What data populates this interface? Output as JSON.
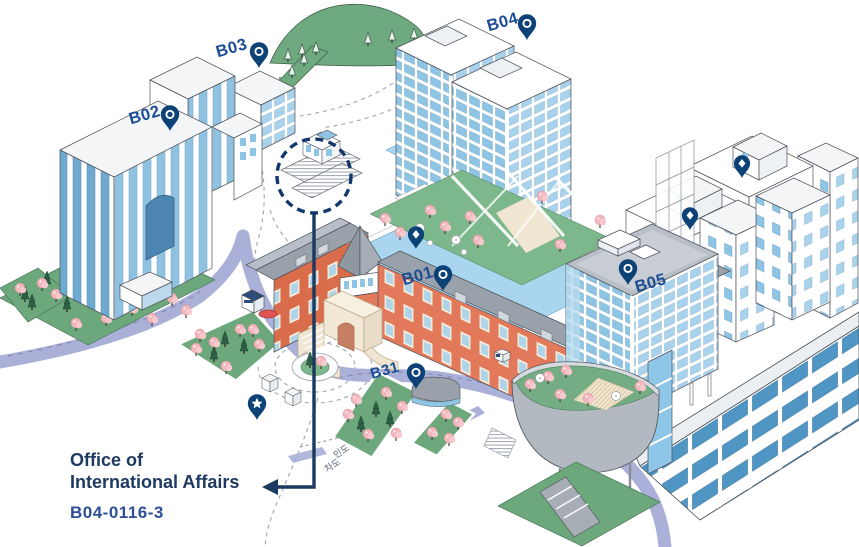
{
  "map": {
    "buildings": {
      "b01": {
        "label": "B01"
      },
      "b02": {
        "label": "B02"
      },
      "b03": {
        "label": "B03"
      },
      "b04": {
        "label": "B04"
      },
      "b05": {
        "label": "B05"
      },
      "b31": {
        "label": "B31"
      }
    },
    "road_labels": {
      "sidewalk": "인도",
      "roadway": "차도"
    },
    "callout": {
      "line1": "Office of",
      "line2": "International Affairs",
      "code": "B04-0116-3"
    },
    "pins": {
      "ring_pins": [
        "B02",
        "B03",
        "B04",
        "B01",
        "B05",
        "B31"
      ],
      "diamond_pins": 3,
      "star_pins": 1
    },
    "highlight": {
      "style": "dashed-circle",
      "target": "rooftop entrance above callout arrow"
    }
  },
  "colors": {
    "pin_navy": "#0d4277",
    "label_blue": "#1b4d94",
    "callout_text": "#1e3a63",
    "callout_code": "#2e4f97",
    "arrow_navy": "#1b3a5f",
    "road_lavender": "#aab0d8",
    "brick_red": "#e2795b",
    "glass_blue": "#8ec4e4",
    "lawn_green": "#6ca87c",
    "roof_gray": "#9aa1ab",
    "blossom_pink": "#f2b6bc",
    "pool_blue": "#a9d6ee",
    "cream": "#f3e8d6"
  }
}
